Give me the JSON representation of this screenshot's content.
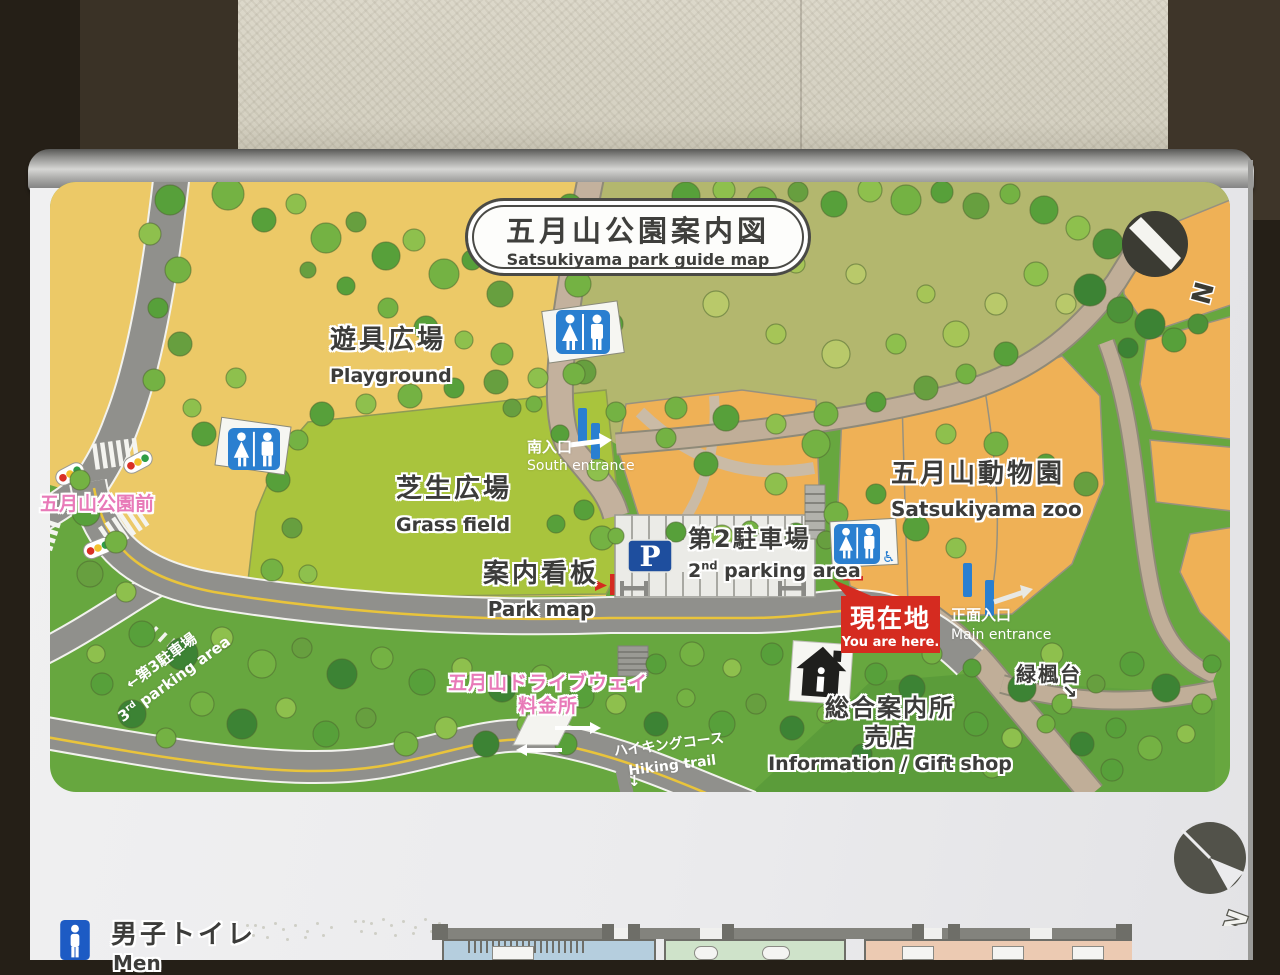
{
  "sign": {
    "title": {
      "jp": "五月山公園案内図",
      "en": "Satsukiyama park guide map"
    },
    "north_letter": "N"
  },
  "areas": {
    "playground": {
      "jp": "遊具広場",
      "en": "Playground"
    },
    "grass_field": {
      "jp": "芝生広場",
      "en": "Grass field"
    },
    "zoo": {
      "jp": "五月山動物園",
      "en": "Satsukiyama zoo"
    }
  },
  "markers": {
    "bus_stop": {
      "jp": "五月山公園前"
    },
    "south_entrance": {
      "jp": "南入口",
      "en": "South entrance"
    },
    "main_entrance": {
      "jp": "正面入口",
      "en": "Main entrance"
    },
    "park_map_sign": {
      "jp": "案内看板",
      "en": "Park map"
    },
    "you_are_here": {
      "jp": "現在地",
      "en": "You are here."
    },
    "parking2": {
      "jp": "第2駐車場",
      "num": "2",
      "sup": "nd",
      "rest": " parking area"
    },
    "parking3": {
      "arrow": "←",
      "jp": "第3駐車場",
      "num": "3",
      "sup": "rd",
      "rest": " parking area"
    },
    "parking_symbol": "P",
    "info_center": {
      "jp1": "総合案内所",
      "jp2": "売店",
      "en": "Information / Gift shop"
    },
    "ryokufudai": {
      "jp": "緑楓台",
      "arrow": "↘"
    },
    "toll_gate": {
      "jp1": "五月山ドライブウェイ",
      "jp2": "料金所"
    },
    "hiking_trail": {
      "jp": "ハイキングコース",
      "en": "Hiking trail",
      "arrow": "↓"
    }
  },
  "legend": {
    "mens_toilet": {
      "jp": "男子トイレ",
      "en": "Men"
    }
  },
  "colors": {
    "here_red": "#d52b20",
    "route_pink": "#e87ab8",
    "sign_blue": "#2a7fd0",
    "parking_navy": "#1e4e9e"
  }
}
